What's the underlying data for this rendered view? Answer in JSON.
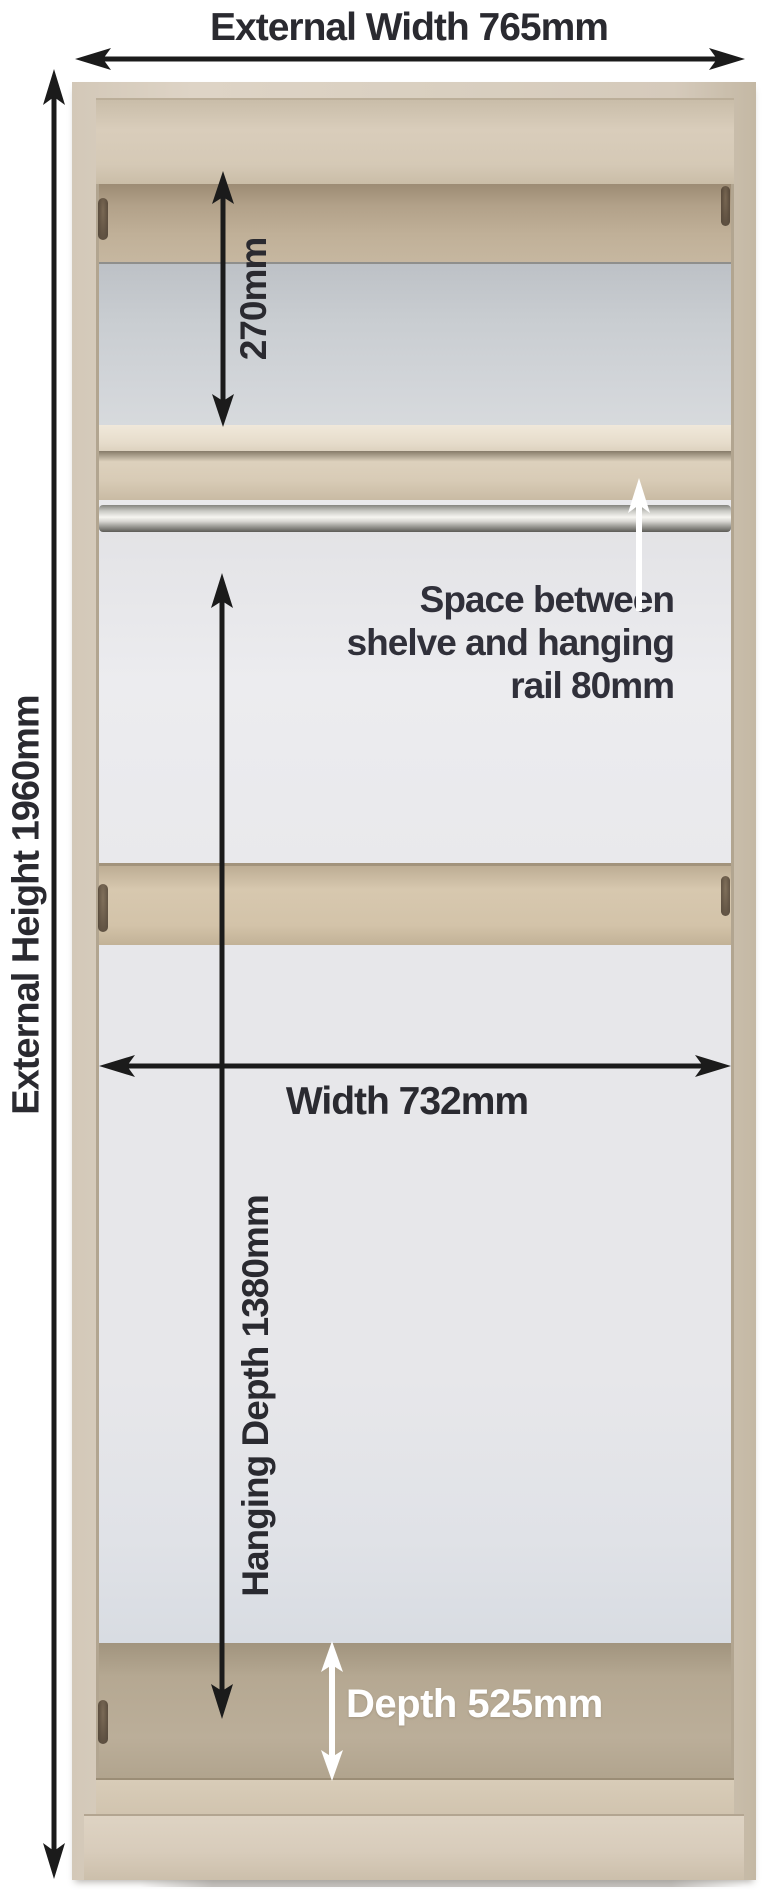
{
  "diagram": {
    "subject": "wardrobe internal dimensions",
    "annotations": {
      "external_width": {
        "label": "External Width 765mm",
        "value_mm": 765
      },
      "external_height": {
        "label": "External Height 1960mm",
        "value_mm": 1960
      },
      "top_shelf_space": {
        "label": "270mm",
        "value_mm": 270
      },
      "shelf_rail_space": {
        "line1": "Space between",
        "line2": "shelve and hanging",
        "line3": "rail 80mm",
        "value_mm": 80
      },
      "internal_width": {
        "label": "Width 732mm",
        "value_mm": 732
      },
      "hanging_depth": {
        "label": "Hanging Depth 1380mm",
        "value_mm": 1380
      },
      "depth": {
        "label": "Depth 525mm",
        "value_mm": 525
      }
    },
    "colors": {
      "annotation_dark": "#1b1b1b",
      "label_text": "#2a2a30",
      "white_label": "#ffffff",
      "wood_light": "#d9cfc1",
      "wood_shadow": "#b2a590",
      "back_panel_gray": "#e9e9ec",
      "rail_metal": "#c9c9c4"
    }
  }
}
